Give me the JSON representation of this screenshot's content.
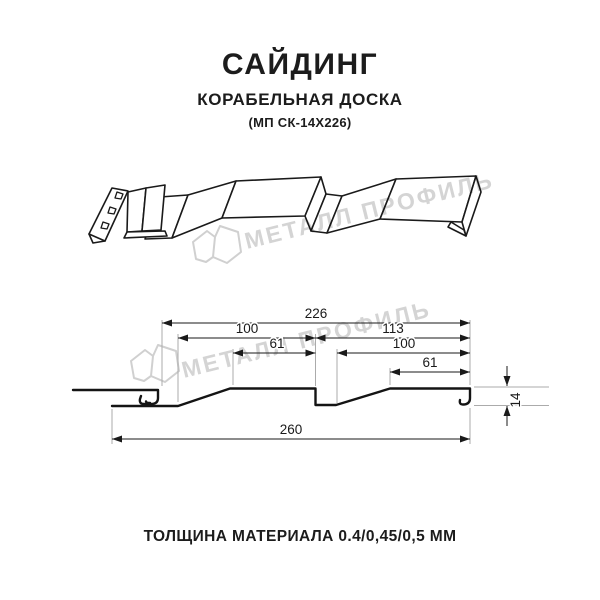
{
  "header": {
    "title": "САЙДИНГ",
    "subtitle": "КОРАБЕЛЬНАЯ ДОСКА",
    "model_code": "(МП СК-14Х226)"
  },
  "watermark": {
    "brand": "МЕТАЛЛ ПРОФИЛЬ",
    "color": "#d4d4d4"
  },
  "section": {
    "dims": {
      "overall_top": "226",
      "upper_left": "100",
      "upper_right": "113",
      "inner_left": "61",
      "inner_right": "100",
      "small_right": "61",
      "overall_bottom": "260",
      "height": "14"
    }
  },
  "footer": {
    "thickness_note": "ТОЛЩИНА МАТЕРИАЛА 0.4/0,45/0,5 ММ"
  },
  "colors": {
    "line": "#1a1a1a",
    "extension_line": "#ababab",
    "background": "#ffffff"
  }
}
